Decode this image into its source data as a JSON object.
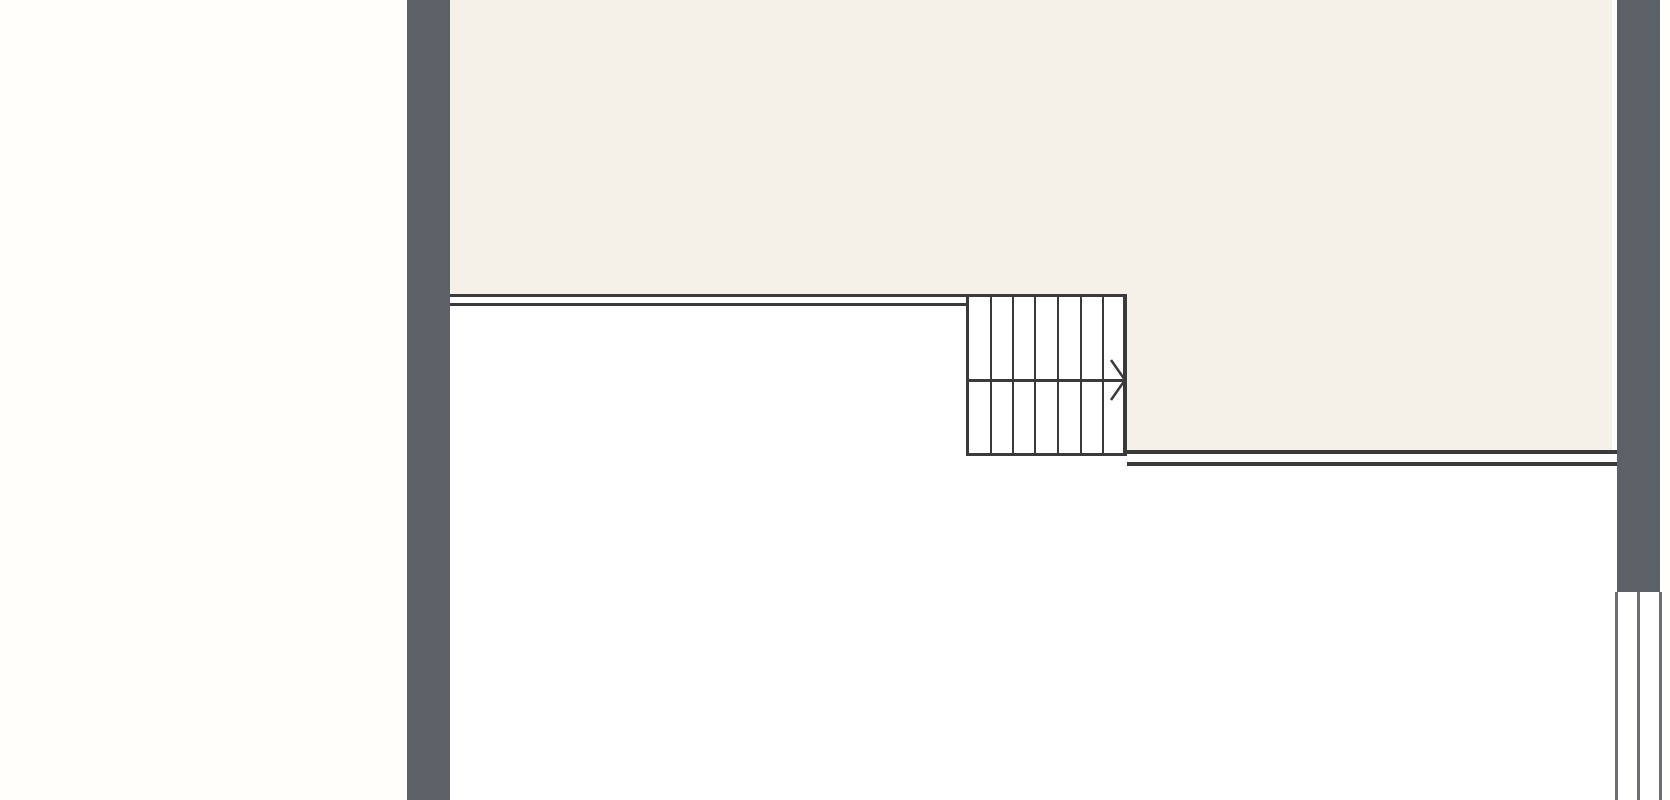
{
  "canvas": {
    "width": 1670,
    "height": 800
  },
  "colors": {
    "page_background": "#fffef8",
    "floor_white": "#ffffff",
    "room_fill": "#f5f1e8",
    "wall_fill": "#5c6067",
    "line_color": "#3a3a3c",
    "window_line_color": "#6b6e74"
  },
  "regions": {
    "floor_area": {
      "x": 450,
      "y": 0,
      "w": 1167,
      "h": 800
    },
    "upper_room": {
      "x": 450,
      "y": 0,
      "w": 1162,
      "h": 294
    },
    "upper_room_right_extension": {
      "x": 1127,
      "y": 294,
      "w": 485,
      "h": 157
    }
  },
  "walls": {
    "left_exterior_wall": {
      "x": 407,
      "y": 0,
      "w": 43,
      "h": 800
    },
    "right_exterior_wall": {
      "x": 1617,
      "y": 0,
      "w": 43,
      "h": 592
    }
  },
  "interior_lines": {
    "upper_wall_outer_line": {
      "x": 450,
      "y": 294,
      "w": 677,
      "h": 3
    },
    "upper_wall_inner_line": {
      "x": 450,
      "y": 303,
      "w": 519,
      "h": 3
    },
    "lower_wall_outer_line": {
      "x": 1125,
      "y": 450,
      "w": 492,
      "h": 4
    },
    "lower_wall_inner_line": {
      "x": 1127,
      "y": 462,
      "w": 490,
      "h": 4
    },
    "wall_end_cap": {
      "x": 1117,
      "y": 294,
      "w": 10,
      "h": 16
    }
  },
  "staircase": {
    "box": {
      "x": 966,
      "y": 297,
      "w": 161,
      "h": 159
    },
    "tread_columns": 7,
    "tread_xs": [
      990,
      1012,
      1034,
      1057,
      1080,
      1102
    ],
    "mid_line_y": 379,
    "direction_arrow": {
      "back_x": 1111,
      "top_y": 360,
      "tip_x": 1125,
      "tip_y": 380,
      "bottom_y": 400
    }
  },
  "window": {
    "box": {
      "x": 1615,
      "y": 592,
      "w": 47,
      "h": 208
    },
    "line_xs": [
      1615,
      1637,
      1659
    ]
  }
}
